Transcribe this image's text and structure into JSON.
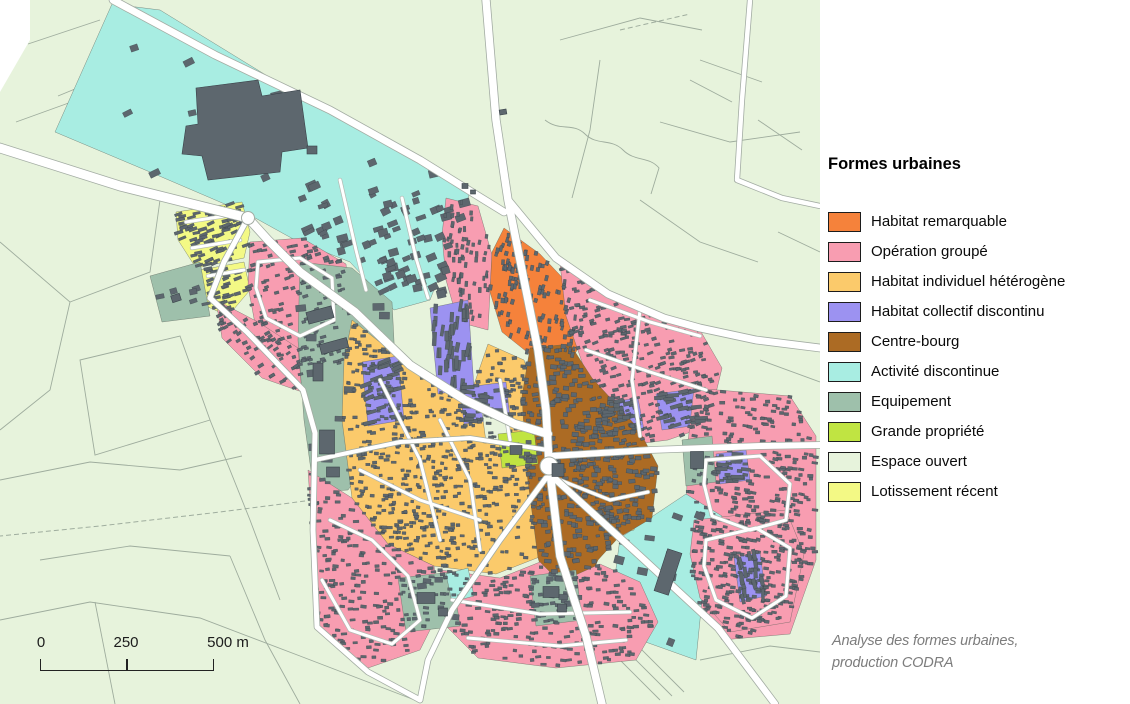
{
  "legend": {
    "title": "Formes urbaines",
    "items": [
      {
        "key": "remarquable",
        "label": "Habitat remarquable",
        "color": "#F5823B"
      },
      {
        "key": "groupe",
        "label": "Opération groupé",
        "color": "#F89DB1"
      },
      {
        "key": "individuel",
        "label": "Habitat individuel hétérogène",
        "color": "#FBCA6B"
      },
      {
        "key": "collectif",
        "label": "Habitat collectif discontinu",
        "color": "#9C92F1"
      },
      {
        "key": "centre",
        "label": "Centre-bourg",
        "color": "#AC6B24"
      },
      {
        "key": "activite",
        "label": "Activité discontinue",
        "color": "#A8EDE2"
      },
      {
        "key": "equipement",
        "label": "Equipement",
        "color": "#9EC0AB"
      },
      {
        "key": "grande",
        "label": "Grande propriété",
        "color": "#C0E442"
      },
      {
        "key": "ouvert",
        "label": "Espace ouvert",
        "color": "#E7F3DC"
      },
      {
        "key": "lotissement",
        "label": "Lotissement récent",
        "color": "#F3F985"
      }
    ]
  },
  "scale_bar": {
    "labels": [
      "0",
      "250",
      "500 m"
    ]
  },
  "attribution": {
    "line1": "Analyse des formes urbaines,",
    "line2": "production CODRA"
  },
  "map": {
    "background": "#E7F3DC",
    "road_fill": "#FFFFFF",
    "road_casing": "#A3ACA3",
    "minor_casing": "#B3BAB3",
    "parcel_line": "#97A597",
    "zone_stroke": "#5A6158",
    "building_color": "#5D676E",
    "building_stroke": "#394249"
  }
}
